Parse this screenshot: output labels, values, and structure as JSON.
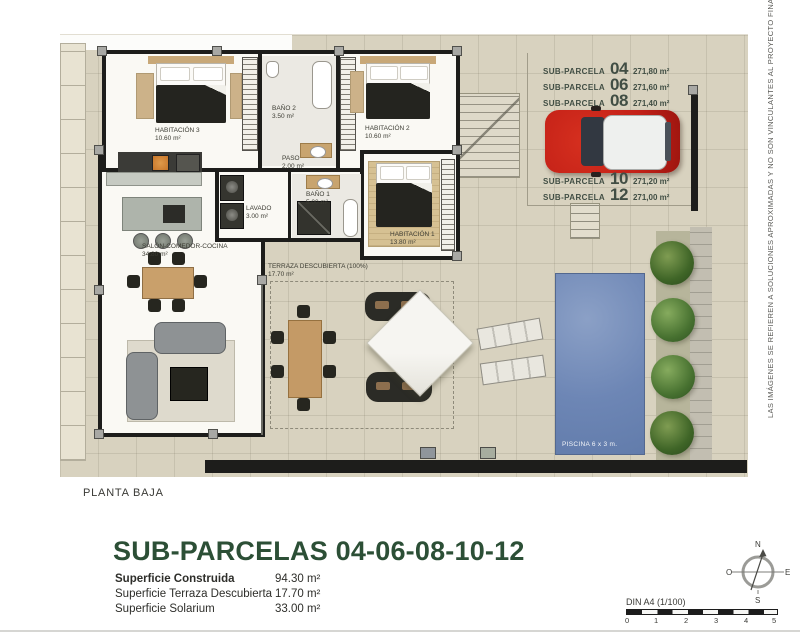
{
  "side_note": "LAS IMÁGENES SE REFIEREN A SOLUCIONES APROXIMADAS Y NO SON VINCULANTES AL PROYECTO FINAL",
  "plan": {
    "rooms": [
      {
        "name": "HABITACIÓN 3",
        "area": "10.60 m²"
      },
      {
        "name": "BAÑO 2",
        "area": "3.50 m²"
      },
      {
        "name": "HABITACIÓN 2",
        "area": "10.60 m²"
      },
      {
        "name": "PASO",
        "area": "2.00 m²"
      },
      {
        "name": "LAVADO",
        "area": "3.00 m²"
      },
      {
        "name": "BAÑO 1",
        "area": "5.00 m²"
      },
      {
        "name": "HABITACIÓN 1",
        "area": "13.80 m²"
      },
      {
        "name": "SALÓN-COMEDOR-COCINA",
        "area": "34.80 m²"
      },
      {
        "name": "TERRAZA DESCUBIERTA (100%)",
        "area": "17.70 m²"
      }
    ],
    "pool_label": "PISCINA 6 x 3 m.",
    "subparcela_label": "SUB-PARCELA",
    "subparcelas": [
      {
        "number": "04",
        "area": "271,80 m²"
      },
      {
        "number": "06",
        "area": "271,60 m²"
      },
      {
        "number": "08",
        "area": "271,40 m²"
      },
      {
        "number": "10",
        "area": "271,20 m²"
      },
      {
        "number": "12",
        "area": "271,00 m²"
      }
    ]
  },
  "footer": {
    "floor_label": "PLANTA BAJA",
    "title": "SUB-PARCELAS 04-06-08-10-12",
    "surfaces": [
      {
        "label": "Superficie Construida",
        "value": "94.30 m²"
      },
      {
        "label": "Superficie Terraza Descubierta",
        "value": "17.70 m²"
      },
      {
        "label": "Superficie Solarium",
        "value": "33.00 m²"
      }
    ],
    "scale": {
      "label": "DIN A4 (1/100)",
      "ticks": [
        "0",
        "1",
        "2",
        "3",
        "4",
        "5"
      ]
    },
    "compass": {
      "n": "N",
      "e": "E",
      "s": "S",
      "o": "O"
    }
  },
  "colors": {
    "accent_green": "#2c4f36",
    "pool_blue": "#6d86b5",
    "car_red": "#c32017",
    "ground": "#d8d2bf"
  }
}
